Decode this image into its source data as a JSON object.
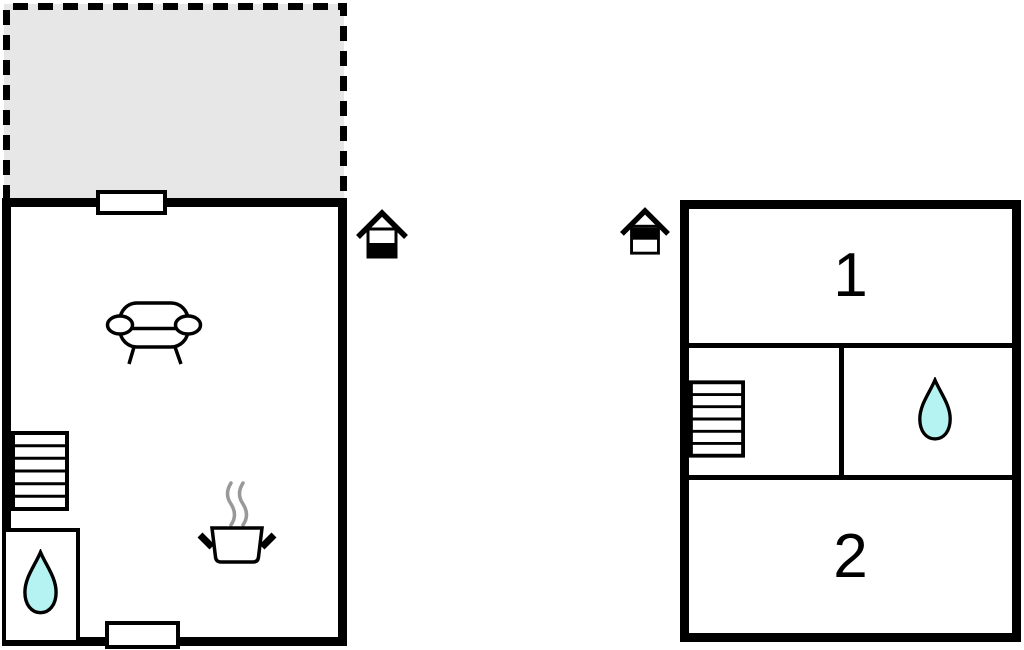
{
  "colors": {
    "wall": "#000000",
    "paper": "#ffffff",
    "terrace_fill": "#e7e7e7",
    "water_fill": "#b5f2f2",
    "steam": "#999999"
  },
  "ground_floor": {
    "terrace": {
      "name": "terrace-open-area",
      "outline": "dashed"
    },
    "icons": {
      "window_top": "window",
      "door_bottom": "door",
      "sofa": "sofa-icon",
      "stairs": "stairs-icon",
      "bath_water_drop": "water-drop-icon",
      "cooking_pot": "cooking-pot-icon"
    },
    "level_indicator": {
      "name": "house-level-icon",
      "filled_half": "bottom"
    }
  },
  "upper_floor": {
    "rooms": [
      {
        "label": "1"
      },
      {
        "label": "2"
      }
    ],
    "icons": {
      "stairs": "stairs-icon",
      "bath_water_drop": "water-drop-icon"
    },
    "level_indicator": {
      "name": "house-level-icon",
      "filled_half": "top"
    }
  }
}
